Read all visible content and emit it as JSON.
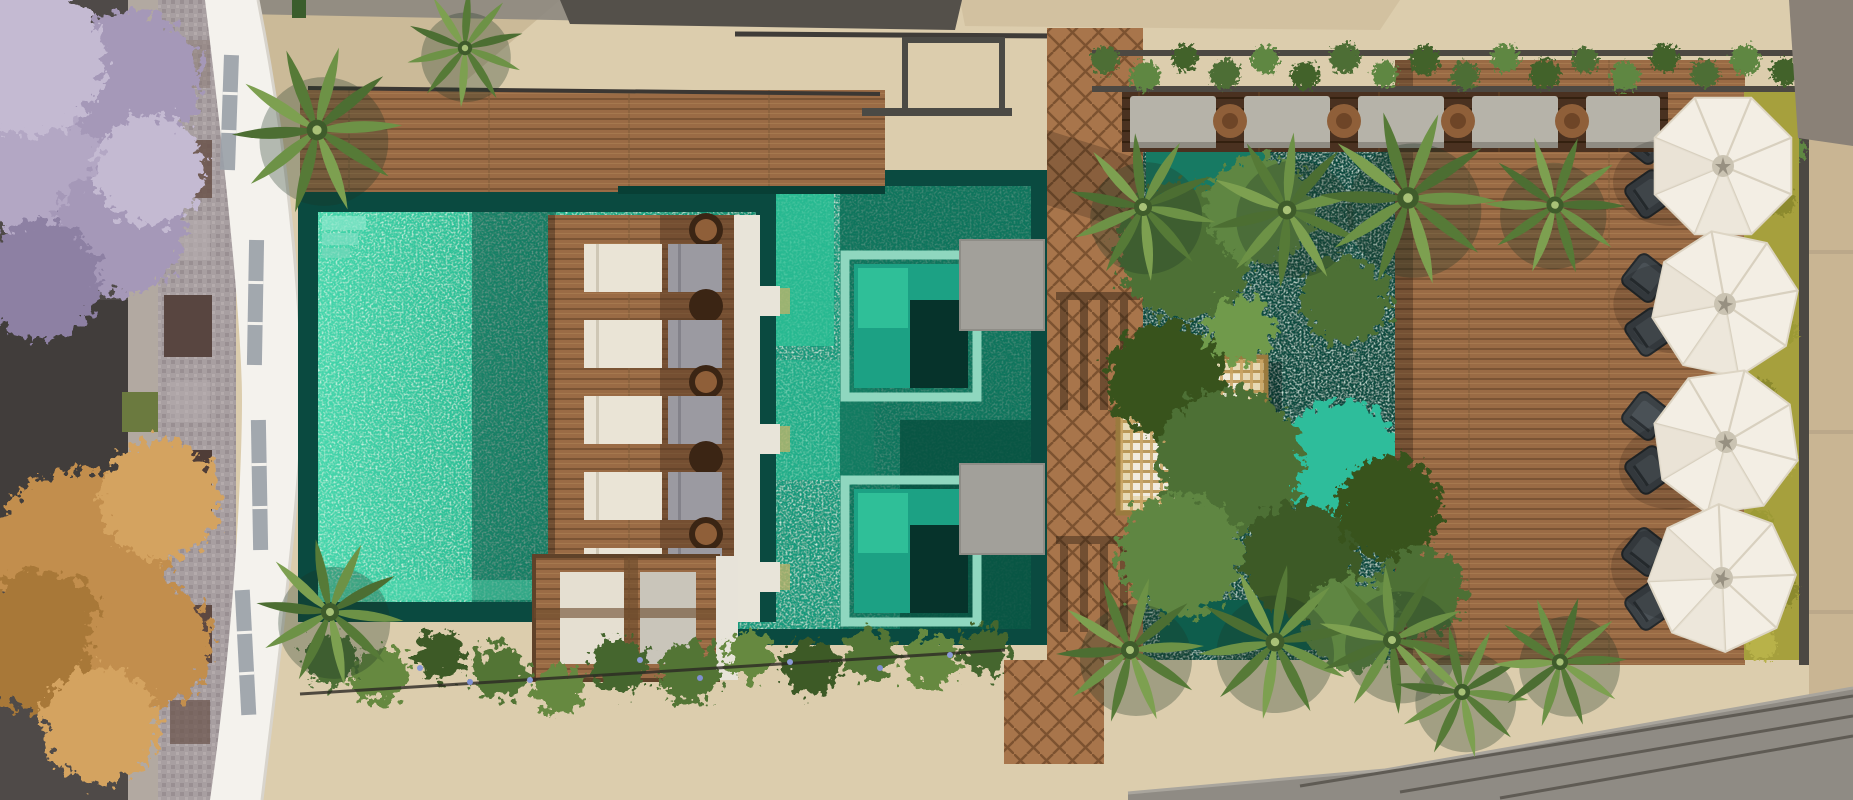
{
  "scene": {
    "type": "aerial-architectural-render",
    "setting": "top-down 3D rendering of a residential rooftop leisure deck with lap pool, tiled leisure pool with spa tubs, sun loungers, pergola, palm garden, umbrella lounge and street edge",
    "counts": {
      "umbrellas": 4,
      "sun_lounger_pairs": 5,
      "spa_tubs": 2,
      "palm_trees": 12,
      "banquette_seats": 5,
      "armchair_pairs": 4
    },
    "areas": [
      "street-with-trees",
      "portuguese-mosaic-sidewalk",
      "curved-white-building",
      "lap-pool",
      "sun-lounger-deck",
      "green-tile-leisure-pool",
      "spa-tubs",
      "in-pool-wood-island",
      "herringbone-walkway",
      "pergola",
      "palm-garden",
      "banquette-row-with-vine-planter",
      "umbrella-lounge-deck",
      "yellow-hedge",
      "flower-hedge-strip",
      "neighbor-roof-slab"
    ]
  },
  "colors": {
    "beige_stone": "#dccdad",
    "beige_shadow": "#c6b392",
    "asphalt": "#4f4a48",
    "median": "#b2a9a1",
    "mosaic_sidewalk": "#a89fa1",
    "building_white": "#f4f2ed",
    "window_glass": "#9aa0a8",
    "pool_border": "#0a4a40",
    "pool_water": "#2fc39c",
    "green_pool_water": "#17997b",
    "green_pool_bright": "#2cc096",
    "green_pool_dark": "#0b6550",
    "spa_deep": "#06332b",
    "spa_frame": "#8fd7bf",
    "wood_deck": "#9a6b45",
    "wood_dark": "#4a3120",
    "herringbone_wood": "#a8754b",
    "white_ledge": "#e8e4d9",
    "lounger_white": "#eae4d6",
    "lounger_gray": "#9b9aa1",
    "pergola_gold": "#c59c55",
    "pergola_base": "#e7d9b5",
    "teal_water": "#0c4c41",
    "stream_bright": "#2dbd9b",
    "bush_green": "#4d7034",
    "palm_green": "#6d9246",
    "palm_green_dark": "#567a37",
    "vine_green": "#4e6e34",
    "yellow_hedge": "#a6a03d",
    "umbrella_white": "#f3eee4",
    "chair_gray": "#3c4246",
    "purple_tree": "#b3a7c4",
    "orange_tree": "#c28e4e",
    "slab_gray": "#8f8b84",
    "pad_gray": "#a2a09a",
    "seat_pad": "#b6b3a9",
    "table_wood": "#8f5f39",
    "flower_blue": "#8b9ad6",
    "planter_frame": "#4c4842"
  }
}
